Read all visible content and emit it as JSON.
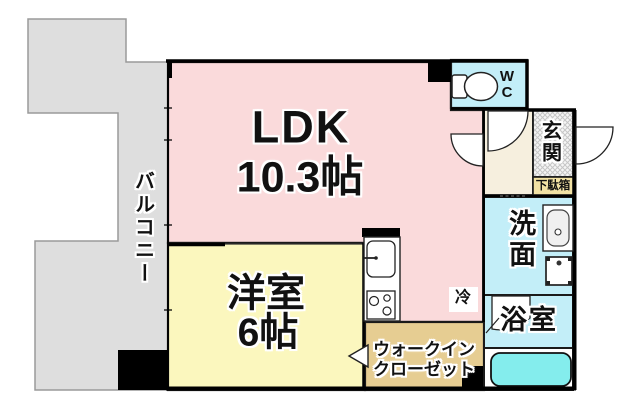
{
  "floor_plan": {
    "balcony": {
      "label": "バルコニー"
    },
    "ldk": {
      "name": "LDK",
      "size": "10.3帖"
    },
    "western_room": {
      "name": "洋室",
      "size": "6帖"
    },
    "walk_in_closet": {
      "line1": "ウォークイン",
      "line2": "クローゼット"
    },
    "kitchen": {
      "refrigerator_label": "冷"
    },
    "wc": {
      "line1": "W",
      "line2": "C"
    },
    "entrance": {
      "label": "玄関"
    },
    "shoe_box": {
      "label": "下駄箱"
    },
    "washroom": {
      "label": "洗面"
    },
    "bathroom": {
      "label": "浴室"
    },
    "colors": {
      "ldk_fill": "#fadadb",
      "western_room_fill": "#fbf7be",
      "wet_area_fill": "#c3eef8",
      "bathtub_fill": "#84eded",
      "hall_fill": "#f6efde",
      "closet_fill": "#e6cd92",
      "shoe_box_fill": "#f2e2a4",
      "balcony_fill": "#dedede",
      "wall": "#000000"
    }
  }
}
